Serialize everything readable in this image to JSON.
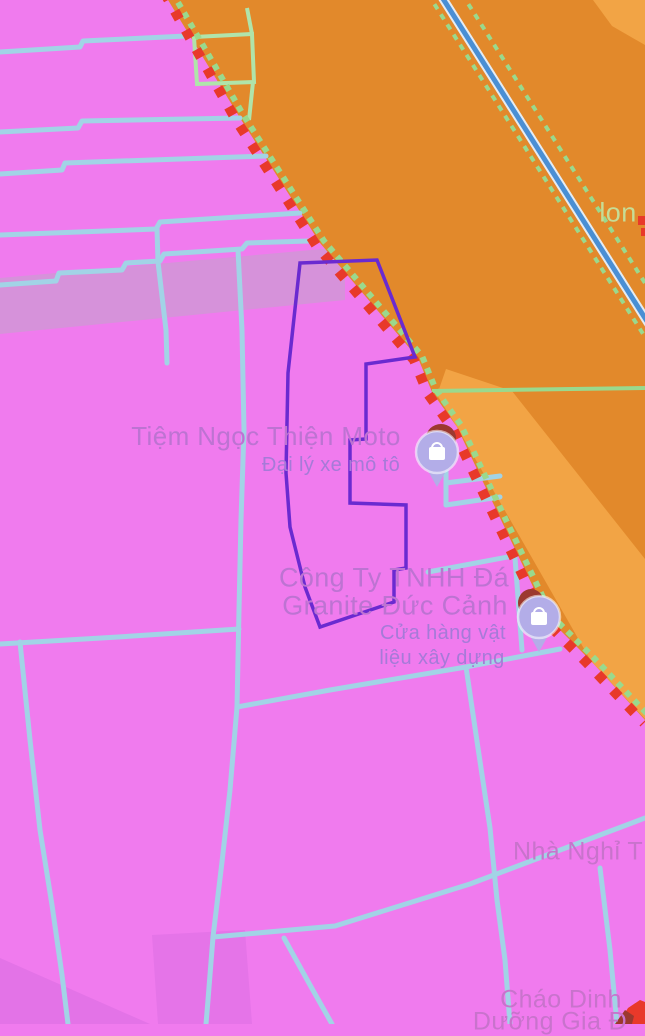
{
  "colors": {
    "pink_zone": "#f07bee",
    "road_band": "#d692da",
    "orange_zone": "#e2892b",
    "orange_zone_light": "#f2a445",
    "boundary_red": "#e8392a",
    "boundary_green": "#9ad98d",
    "parcel_line": "#a2d3e6",
    "parcel_line_green": "#b0e4aa",
    "road_blue": "#4a8fd4",
    "road_casing": "#e4ecf4",
    "selection_purple": "#6a2ad0",
    "pin_fill": "#b3ade8",
    "pin_blob": "#9c382f"
  },
  "pois": {
    "moto": {
      "name": "Tiệm Ngọc Thiện Moto",
      "subtitle": "Đại lý xe mô tô"
    },
    "granite": {
      "name_line1": "Công Ty TNHH Đá",
      "name_line2": "Granite Đức Cảnh",
      "subtitle_line1": "Cửa hàng vật",
      "subtitle_line2": "liệu xây dựng"
    },
    "guesthouse": {
      "name": "Nhà Nghỉ T"
    },
    "porridge": {
      "name_line1": "Cháo Dinh",
      "name_line2": "Dưỡng Gia Đ"
    }
  },
  "road": {
    "label": "lon"
  }
}
